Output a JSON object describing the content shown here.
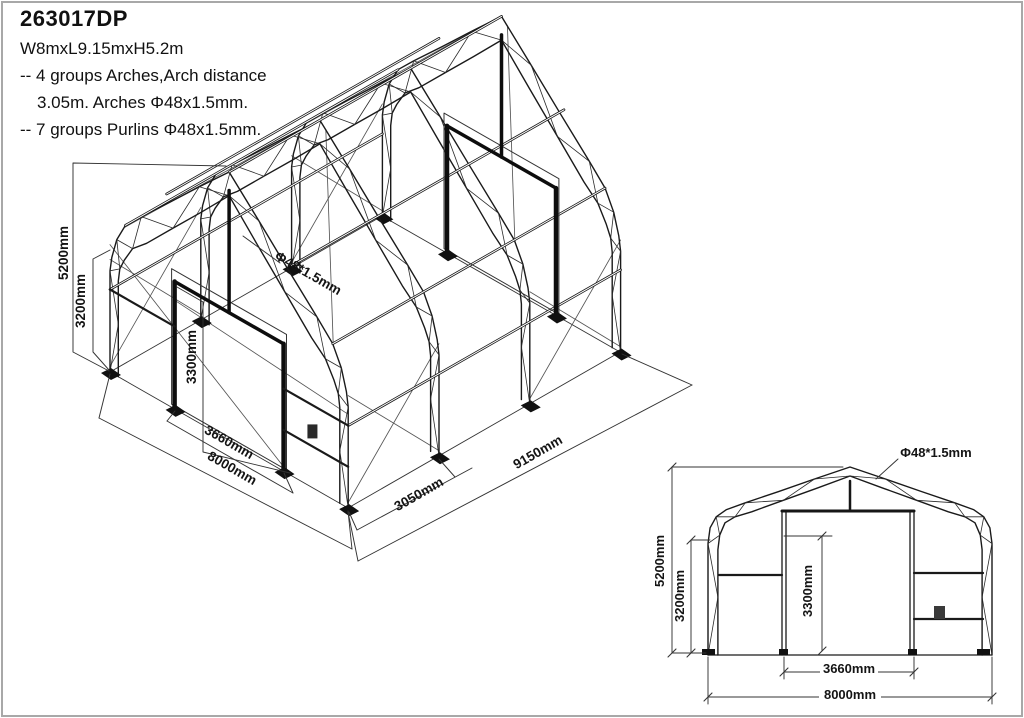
{
  "header": {
    "code": "263017DP",
    "size": "W8mxL9.15mxH5.2m",
    "spec1": "-- 4 groups Arches,Arch distance",
    "spec2": "3.05m. Arches Φ48x1.5mm.",
    "spec3": "-- 7 groups Purlins Φ48x1.5mm."
  },
  "iso_view": {
    "dim_height_overall": "5200mm",
    "dim_height_shoulder": "3200mm",
    "dim_door_height": "3300mm",
    "dim_door_width": "3660mm",
    "dim_width": "8000mm",
    "dim_arch_spacing": "3050mm",
    "dim_length": "9150mm",
    "label_pipe": "Φ48*1.5mm"
  },
  "elevation_view": {
    "dim_height_overall": "5200mm",
    "dim_height_shoulder": "3200mm",
    "dim_door_height": "3300mm",
    "dim_door_width": "3660mm",
    "dim_width": "8000mm",
    "label_pipe": "Φ48*1.5mm"
  }
}
